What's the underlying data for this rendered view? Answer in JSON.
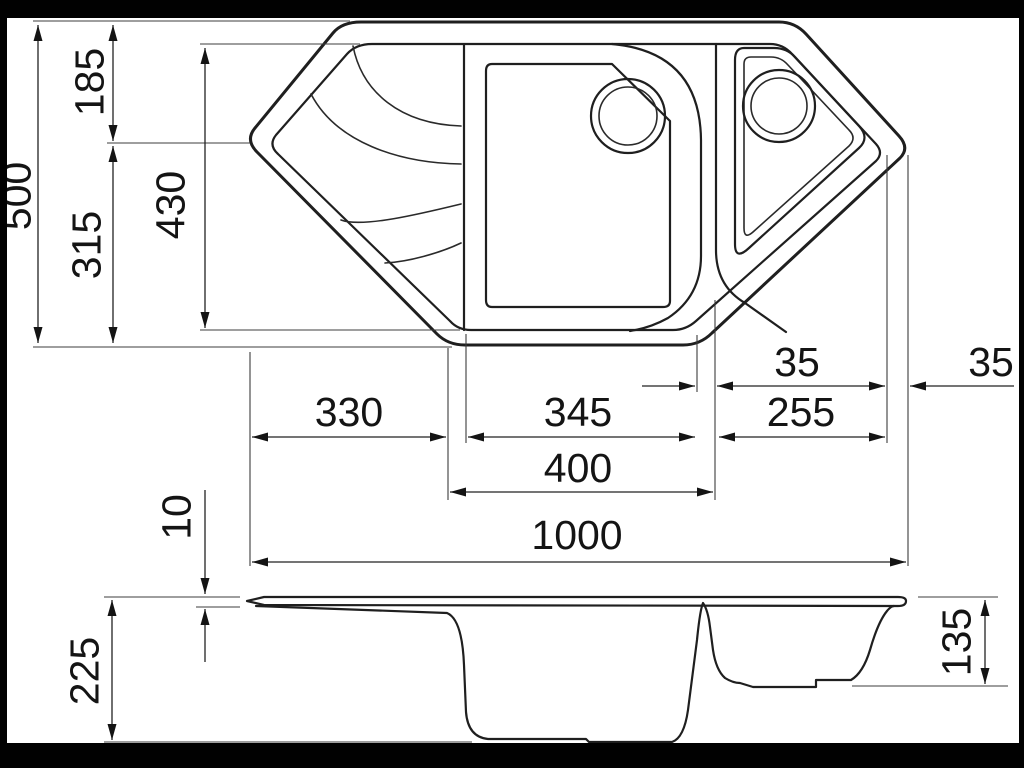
{
  "drawing": {
    "type": "technical-drawing",
    "subject": "corner kitchen sink with drainer, main bowl and half bowl (plan view and section view)",
    "colors": {
      "background": "#ffffff",
      "line": "#1f1f1f",
      "frame": "#010101"
    }
  },
  "plan_view": {
    "dimensions": {
      "overall_width": "1000",
      "overall_depth": "500",
      "rear_section_depth": "185",
      "front_section_depth": "315",
      "inner_opening_depth": "430",
      "drainer_width": "330",
      "main_bowl_width": "345",
      "bowl_span_width": "400",
      "small_bowl_width": "255",
      "divider_wall_width": "35",
      "corner_rim_width": "35"
    }
  },
  "section_view": {
    "dimensions": {
      "rim_thickness": "10",
      "overall_height": "225",
      "small_bowl_depth": "135"
    }
  }
}
